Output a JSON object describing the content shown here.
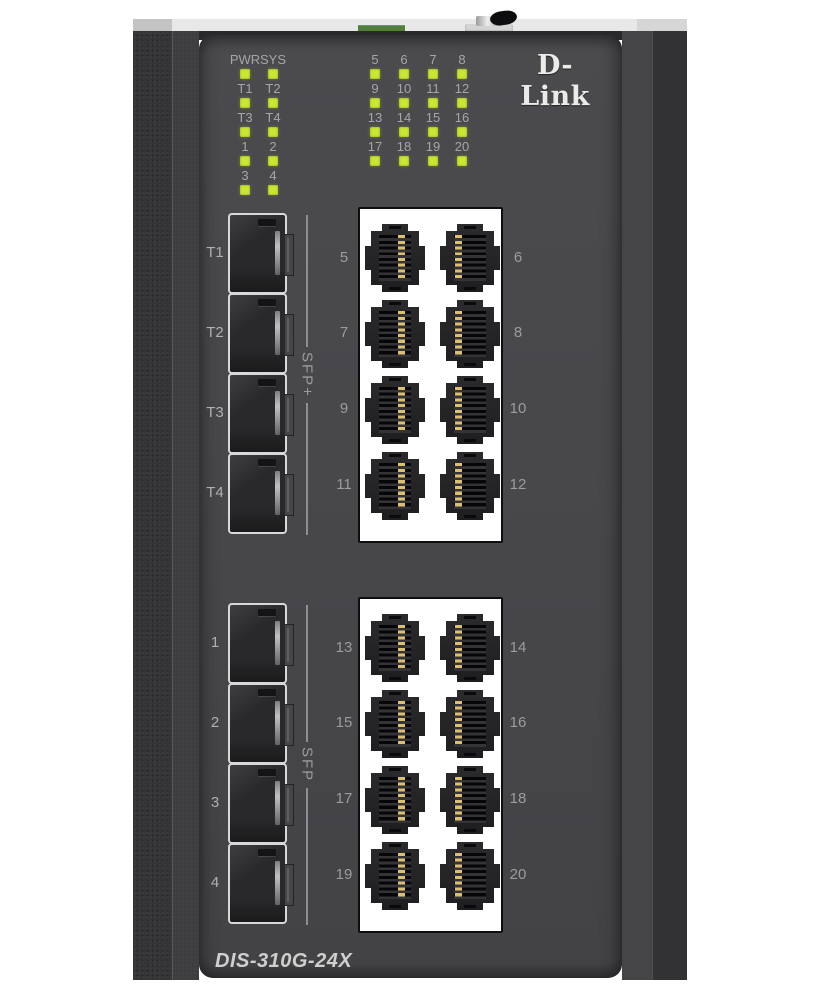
{
  "device": {
    "brand": "D-Link",
    "model": "DIS-310G-24X"
  },
  "led_panel": {
    "left_rows": [
      [
        "PWR",
        "SYS"
      ],
      [
        "T1",
        "T2"
      ],
      [
        "T3",
        "T4"
      ],
      [
        "1",
        "2"
      ],
      [
        "3",
        "4"
      ]
    ],
    "right_rows": [
      [
        "5",
        "6",
        "7",
        "8"
      ],
      [
        "9",
        "10",
        "11",
        "12"
      ],
      [
        "13",
        "14",
        "15",
        "16"
      ],
      [
        "17",
        "18",
        "19",
        "20"
      ]
    ],
    "led_state": "on",
    "led_color": "#c9e733"
  },
  "sfp_groups": [
    {
      "bracket_label": "SFP+",
      "ports": [
        "T1",
        "T2",
        "T3",
        "T4"
      ]
    },
    {
      "bracket_label": "SFP",
      "ports": [
        "1",
        "2",
        "3",
        "4"
      ]
    }
  ],
  "rj45_groups": [
    {
      "left_labels": [
        "5",
        "7",
        "9",
        "11"
      ],
      "right_labels": [
        "6",
        "8",
        "10",
        "12"
      ]
    },
    {
      "left_labels": [
        "13",
        "15",
        "17",
        "19"
      ],
      "right_labels": [
        "14",
        "16",
        "18",
        "20"
      ]
    }
  ],
  "colors": {
    "panel": "#47474a",
    "chassis_side": "#353537",
    "top_cap": "#e8e8e8",
    "terminal_block_green": "#527f3e",
    "led_green": "#c9e733",
    "label_gray": "#a6a6a8",
    "port_panel_white": "#ffffff",
    "pin_gold": "#dcc06e",
    "logo_white": "#ebebe9"
  }
}
